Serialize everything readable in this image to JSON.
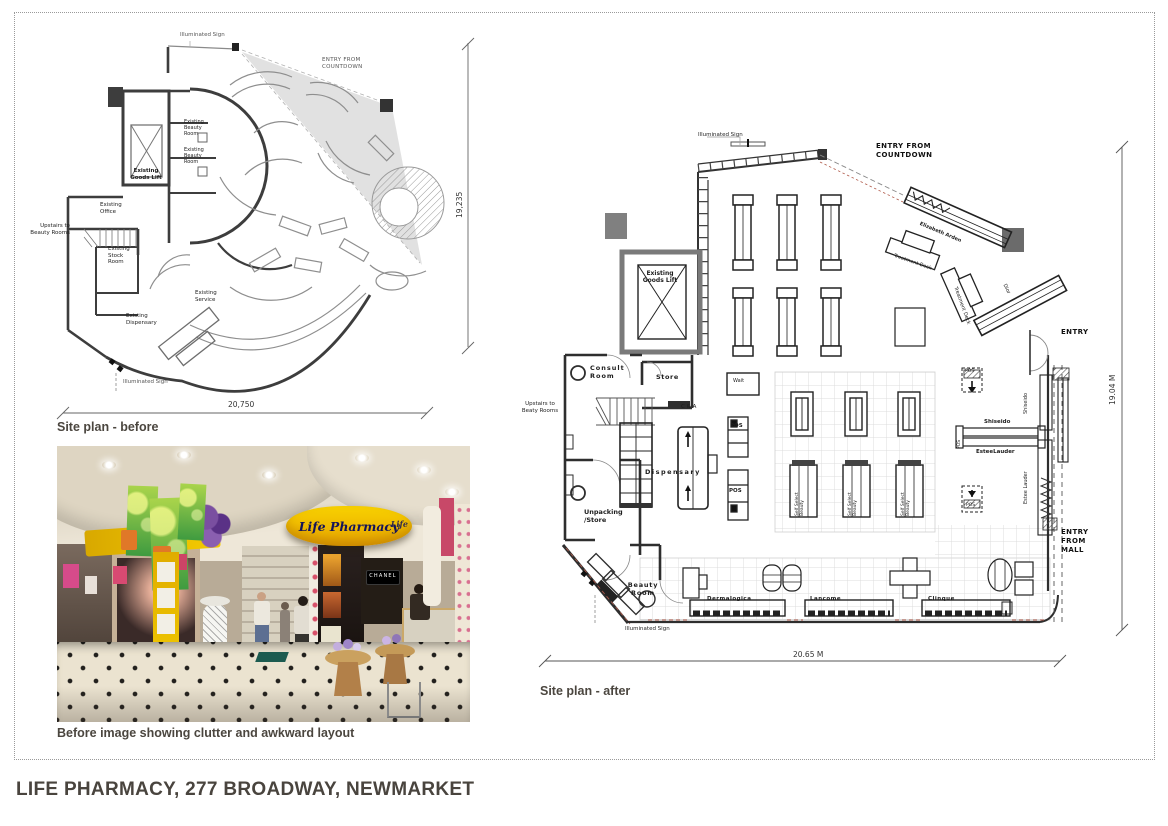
{
  "page": {
    "title": "LIFE PHARMACY, 277 BROADWAY, NEWMARKET"
  },
  "before": {
    "caption": "Site plan - before",
    "dim_width": "20,750",
    "dim_height": "19,235",
    "labels": {
      "illuminated_sign": "Illuminated Sign",
      "entry_from_countdown": "ENTRY FROM\nCOUNTDOWN",
      "existing_beauty_room": "Existing\nBeauty\nRoom",
      "existing_goods_lift": "Existing\nGoods Lift",
      "existing_office": "Existing\nOffice",
      "upstairs": "Upstairs to\nBeauty Rooms",
      "existing_stock_room": "Existing\nStock\nRoom",
      "existing_service": "Existing\nService",
      "existing_dispensary": "Existing\nDispensary",
      "illuminated_sign2": "Illuminated Sign"
    }
  },
  "photo": {
    "caption": "Before image showing clutter and awkward layout",
    "sign_text": "Life Pharmacy",
    "sign_text_right": "Life",
    "chanel": "CHANEL"
  },
  "after": {
    "caption": "Site plan - after",
    "dim_width": "20.65 M",
    "dim_height": "19.04 M",
    "labels": {
      "illuminated_sign_top": "Illuminated Sign",
      "entry_from_countdown": "ENTRY FROM\nCOUNTDOWN",
      "existing_goods_lift": "Existing\nGoods Lift",
      "consult_room": "Consult\nRoom",
      "store": "Store",
      "c_and_a": "C & A",
      "upstairs": "Upstairs to\nBeaty Rooms",
      "wait": "Wait",
      "pos": "POS",
      "dispensary": "Dispensary",
      "unpacking_store": "Unpacking\n/Store",
      "beauty_room": "Beauty\nRoom",
      "illuminated_sign_bottom": "Illuminated Sign",
      "elizabeth_arden": "Elizabeth Arden",
      "treatment_deck": "Treatment Deck",
      "dior": "Dior",
      "entry": "ENTRY",
      "entry_from_mall": "ENTRY\nFROM\nMALL",
      "shiseido": "Shiseido",
      "estee_lauder_joined": "EsteeLauder",
      "estee_lauder": "Estee Lauder",
      "self_select": "Self Select\nBeauty",
      "dermalogica": "Dermalogica",
      "lancome": "Lancome",
      "clinique": "Clinque"
    }
  }
}
